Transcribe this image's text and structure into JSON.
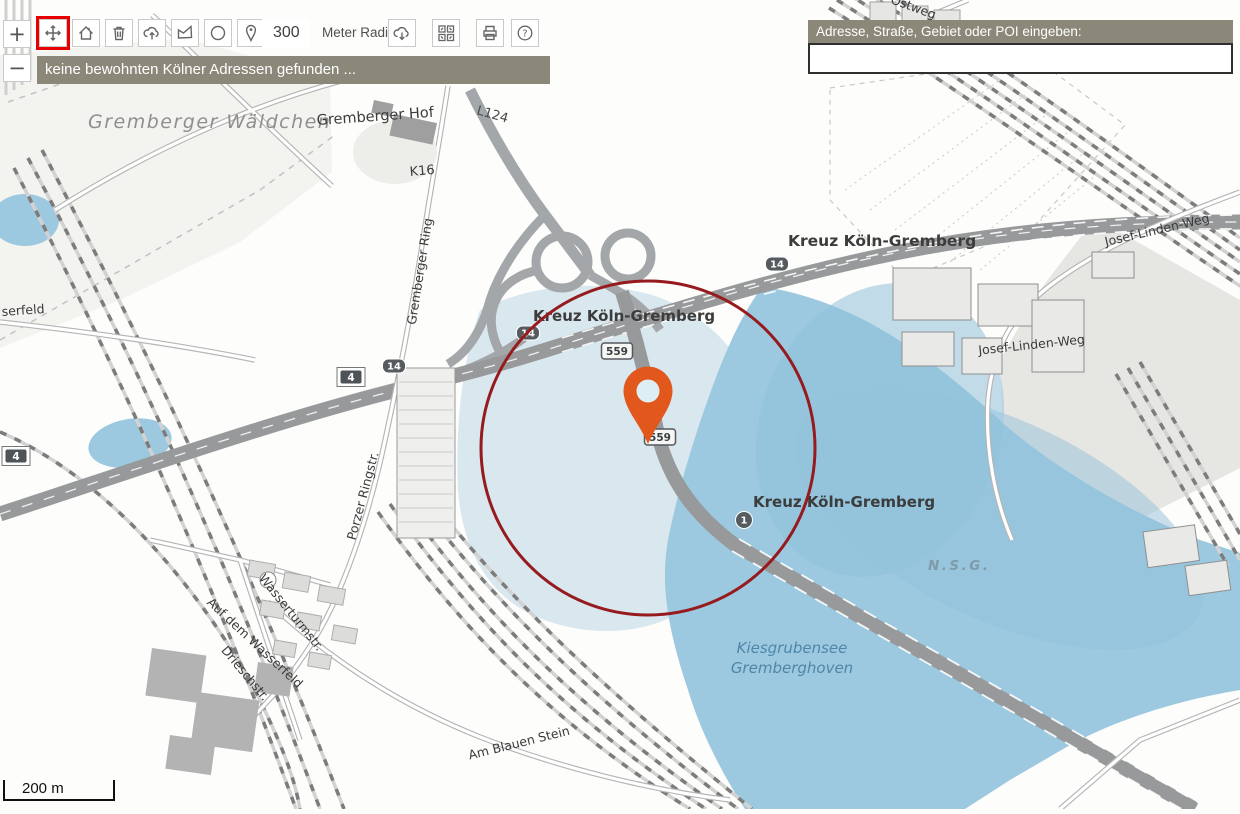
{
  "toolbar": {
    "zoom_in_label": "+",
    "zoom_out_label": "−",
    "radius_value": "300",
    "radius_unit_label": "Meter Radius"
  },
  "status_bar": {
    "message": "keine bewohnten Kölner Adressen gefunden ..."
  },
  "search": {
    "label": "Adresse, Straße, Gebiet oder POI eingeben:",
    "value": ""
  },
  "scale_bar": {
    "label": "200 m"
  },
  "colors": {
    "selection_accent": "#e60000",
    "panel_bg": "#8b887a",
    "radius_circle": "#961b1e",
    "pin": "#e2571c",
    "water": "#9cc9e0",
    "water_pale": "#d9e7ee"
  },
  "map": {
    "labels": {
      "forest": "Gremberger Wäldchen",
      "hof": "Gremberger Hof",
      "l124": "L124",
      "k16": "K16",
      "kreuz_right": "Kreuz Köln-Gremberg",
      "kreuz_mid": "Kreuz Köln-Gremberg",
      "kreuz_low": "Kreuz Köln-Gremberg",
      "nsg": "N.S.G.",
      "lake_line1": "Kiesgrubensee",
      "lake_line2": "Gremberghoven",
      "gremberger_ring": "Gremberger Ring",
      "porzer": "Porzer Ringstr.",
      "wasserturm": "Wasserturmstr.",
      "auf_dem_wasserfeld": "Auf dem Wasserfeld",
      "driesch": "Drieschstr.",
      "blauen_stein": "Am Blauen Stein",
      "josef_1": "Josef-Linden-Weg",
      "josef_2": "Josef-Linden-Weg",
      "ostweg": "Ostweg",
      "serfeld": "serfeld"
    },
    "badges": {
      "a4_left": "4",
      "a4_mid": "4",
      "b14_a": "14",
      "b14_b": "14",
      "b14_c": "14",
      "b559_a": "559",
      "b559_b": "559",
      "a1": "1"
    }
  }
}
